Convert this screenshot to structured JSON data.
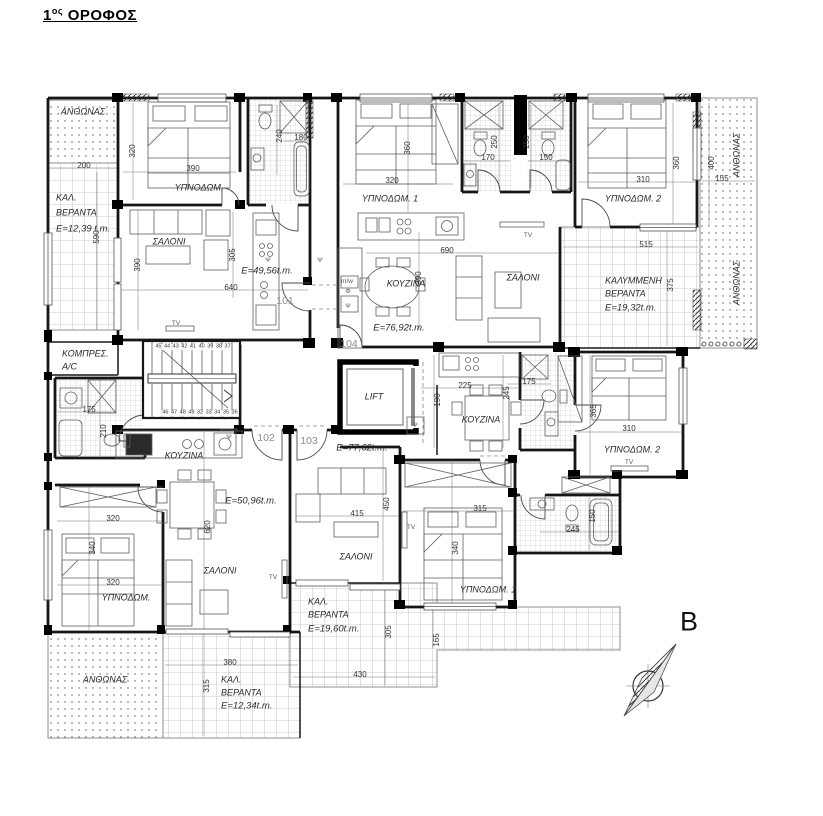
{
  "title": {
    "number": "1",
    "sup": "ος",
    "rest": " ΟΡΟΦΟΣ"
  },
  "plan": {
    "apartments": [
      {
        "number": "101",
        "area": "E=49,56t.m."
      },
      {
        "number": "102",
        "area": "E=50,96t.m."
      },
      {
        "number": "103",
        "area": "E=77,62t.m."
      },
      {
        "number": "104",
        "area": "E=76,92t.m."
      }
    ],
    "labels": [
      {
        "t": "ΑΝΘΩΝΑΣ",
        "x": 83,
        "y": 112,
        "c": "room",
        "n": "planter-label"
      },
      {
        "t": "200",
        "x": 84,
        "y": 166,
        "c": "dim",
        "n": "dim-label"
      },
      {
        "t": "ΚΑΛ.",
        "x": 56,
        "y": 198,
        "c": "room left",
        "n": "veranda-label"
      },
      {
        "t": "ΒΕΡΑΝΤΑ",
        "x": 56,
        "y": 213,
        "c": "room left",
        "n": "veranda-label"
      },
      {
        "t": "E=12,39 t.m.",
        "x": 56,
        "y": 229,
        "c": "area left",
        "n": "area-label"
      },
      {
        "t": "590",
        "x": 97,
        "y": 237,
        "r": -90,
        "c": "dim",
        "n": "dim-label"
      },
      {
        "t": "320",
        "x": 133,
        "y": 151,
        "r": -90,
        "c": "dim",
        "n": "dim-label"
      },
      {
        "t": "390",
        "x": 193,
        "y": 169,
        "c": "dim",
        "n": "dim-label"
      },
      {
        "t": "ΥΠΝΟΔΩΜ.",
        "x": 199,
        "y": 188,
        "c": "room",
        "n": "room-label"
      },
      {
        "t": "240",
        "x": 280,
        "y": 136,
        "r": -90,
        "c": "dim",
        "n": "dim-label"
      },
      {
        "t": "180",
        "x": 301,
        "y": 138,
        "c": "dim",
        "n": "dim-label"
      },
      {
        "t": "ΣΑΛΟΝΙ",
        "x": 169,
        "y": 242,
        "c": "room",
        "n": "room-label"
      },
      {
        "t": "390",
        "x": 138,
        "y": 265,
        "r": -90,
        "c": "dim",
        "n": "dim-label"
      },
      {
        "t": "305",
        "x": 233,
        "y": 255,
        "r": -90,
        "c": "dim",
        "n": "dim-label"
      },
      {
        "t": "E=49,56t.m.",
        "x": 267,
        "y": 271,
        "c": "area",
        "n": "area-label"
      },
      {
        "t": "640",
        "x": 231,
        "y": 288,
        "c": "dim",
        "n": "dim-label"
      },
      {
        "t": "101",
        "x": 285,
        "y": 301,
        "c": "num",
        "n": "apartment-number"
      },
      {
        "t": "TV",
        "x": 176,
        "y": 324,
        "c": "tiny",
        "n": "tv-label"
      },
      {
        "t": "Ψ",
        "x": 268,
        "y": 261,
        "c": "tiny",
        "n": "appliance-label"
      },
      {
        "t": "360",
        "x": 408,
        "y": 148,
        "r": -90,
        "c": "dim",
        "n": "dim-label"
      },
      {
        "t": "320",
        "x": 392,
        "y": 181,
        "c": "dim",
        "n": "dim-label"
      },
      {
        "t": "ΥΠΝΟΔΩΜ. 1",
        "x": 390,
        "y": 199,
        "c": "room",
        "n": "room-label"
      },
      {
        "t": "250",
        "x": 495,
        "y": 142,
        "r": -90,
        "c": "dim",
        "n": "dim-label"
      },
      {
        "t": "170",
        "x": 488,
        "y": 158,
        "c": "dim",
        "n": "dim-label"
      },
      {
        "t": "250",
        "x": 527,
        "y": 142,
        "r": -90,
        "c": "dim",
        "n": "dim-label"
      },
      {
        "t": "150",
        "x": 546,
        "y": 158,
        "c": "dim",
        "n": "dim-label"
      },
      {
        "t": "Ψ",
        "x": 320,
        "y": 261,
        "c": "tiny",
        "n": "appliance-label"
      },
      {
        "t": "m/w",
        "x": 347,
        "y": 282,
        "c": "tiny",
        "n": "appliance-label"
      },
      {
        "t": "Φ",
        "x": 348,
        "y": 292,
        "c": "tiny",
        "n": "appliance-label"
      },
      {
        "t": "Ψ",
        "x": 348,
        "y": 307,
        "c": "tiny",
        "n": "appliance-label"
      },
      {
        "t": "ΚΟΥΖΙΝΑ",
        "x": 406,
        "y": 284,
        "c": "room",
        "n": "room-label"
      },
      {
        "t": "690",
        "x": 447,
        "y": 251,
        "c": "dim",
        "n": "dim-label"
      },
      {
        "t": "390",
        "x": 419,
        "y": 278,
        "r": -90,
        "c": "dim",
        "n": "dim-label"
      },
      {
        "t": "E=76,92t.m.",
        "x": 399,
        "y": 328,
        "c": "area",
        "n": "area-label"
      },
      {
        "t": "ΣΑΛΟΝΙ",
        "x": 523,
        "y": 278,
        "c": "room",
        "n": "room-label"
      },
      {
        "t": "TV",
        "x": 528,
        "y": 236,
        "c": "tiny",
        "n": "tv-label"
      },
      {
        "t": "104",
        "x": 349,
        "y": 344,
        "c": "num",
        "n": "apartment-number"
      },
      {
        "t": "360",
        "x": 677,
        "y": 163,
        "r": -90,
        "c": "dim",
        "n": "dim-label"
      },
      {
        "t": "310",
        "x": 643,
        "y": 180,
        "c": "dim",
        "n": "dim-label"
      },
      {
        "t": "ΥΠΝΟΔΩΜ. 2",
        "x": 633,
        "y": 199,
        "c": "room",
        "n": "room-label"
      },
      {
        "t": "400",
        "x": 712,
        "y": 163,
        "r": -90,
        "c": "dim",
        "n": "dim-label"
      },
      {
        "t": "155",
        "x": 722,
        "y": 179,
        "c": "dim",
        "n": "dim-label"
      },
      {
        "t": "ΑΝΘΩΝΑΣ",
        "x": 737,
        "y": 155,
        "r": -90,
        "c": "room",
        "n": "planter-label"
      },
      {
        "t": "515",
        "x": 646,
        "y": 245,
        "c": "dim",
        "n": "dim-label"
      },
      {
        "t": "ΚΑΛΥΜΜΕΝΗ",
        "x": 605,
        "y": 281,
        "c": "room left",
        "n": "veranda-label"
      },
      {
        "t": "ΒΕΡΑΝΤΑ",
        "x": 605,
        "y": 294,
        "c": "room left",
        "n": "veranda-label"
      },
      {
        "t": "E=19,32t.m.",
        "x": 605,
        "y": 308,
        "c": "area left",
        "n": "area-label"
      },
      {
        "t": "375",
        "x": 671,
        "y": 285,
        "r": -90,
        "c": "dim",
        "n": "dim-label"
      },
      {
        "t": "ΑΝΘΩΝΑΣ",
        "x": 737,
        "y": 283,
        "r": -90,
        "c": "room",
        "n": "planter-label"
      },
      {
        "t": "ΚΟΜΠΡΕΣ.",
        "x": 62,
        "y": 354,
        "c": "room left",
        "n": "room-label"
      },
      {
        "t": "A/C",
        "x": 62,
        "y": 367,
        "c": "room left",
        "n": "room-label"
      },
      {
        "t": "175",
        "x": 89,
        "y": 410,
        "c": "dim",
        "n": "dim-label"
      },
      {
        "t": "210",
        "x": 104,
        "y": 431,
        "r": -90,
        "c": "dim",
        "n": "dim-label"
      },
      {
        "t": "45 44 43 42 41 40 39 38 37",
        "x": 193,
        "y": 347,
        "c": "stair",
        "n": "stair-step-numbers"
      },
      {
        "t": "46 47 48 49 32 33 34 35 36",
        "x": 200,
        "y": 413,
        "c": "stair",
        "n": "stair-step-numbers"
      },
      {
        "t": "LIFT",
        "x": 374,
        "y": 397,
        "c": "room",
        "n": "lift-label"
      },
      {
        "t": "102",
        "x": 266,
        "y": 438,
        "c": "num",
        "n": "apartment-number"
      },
      {
        "t": "103",
        "x": 309,
        "y": 441,
        "c": "num",
        "n": "apartment-number"
      },
      {
        "t": "E=77,62t.m.",
        "x": 362,
        "y": 448,
        "c": "area",
        "n": "area-label"
      },
      {
        "t": "225",
        "x": 465,
        "y": 386,
        "c": "dim",
        "n": "dim-label"
      },
      {
        "t": "190",
        "x": 438,
        "y": 400,
        "r": -90,
        "c": "dim",
        "n": "dim-label"
      },
      {
        "t": "175",
        "x": 529,
        "y": 382,
        "c": "dim",
        "n": "dim-label"
      },
      {
        "t": "245",
        "x": 507,
        "y": 393,
        "r": -90,
        "c": "dim",
        "n": "dim-label"
      },
      {
        "t": "ΚΟΥΖΙΝΑ",
        "x": 481,
        "y": 420,
        "c": "room",
        "n": "room-label"
      },
      {
        "t": "Ψ",
        "x": 415,
        "y": 426,
        "c": "tiny",
        "n": "appliance-label"
      },
      {
        "t": "365",
        "x": 594,
        "y": 411,
        "r": -90,
        "c": "dim",
        "n": "dim-label"
      },
      {
        "t": "310",
        "x": 629,
        "y": 429,
        "c": "dim",
        "n": "dim-label"
      },
      {
        "t": "ΥΠΝΟΔΩΜ. 2",
        "x": 632,
        "y": 450,
        "c": "room",
        "n": "room-label"
      },
      {
        "t": "TV",
        "x": 629,
        "y": 463,
        "c": "tiny",
        "n": "tv-label"
      },
      {
        "t": "245",
        "x": 573,
        "y": 530,
        "c": "dim",
        "n": "dim-label"
      },
      {
        "t": "150",
        "x": 593,
        "y": 516,
        "r": -90,
        "c": "dim",
        "n": "dim-label"
      },
      {
        "t": "ΚΟΥΖΙΝΑ",
        "x": 184,
        "y": 456,
        "c": "room",
        "n": "room-label"
      },
      {
        "t": "Ψ",
        "x": 229,
        "y": 438,
        "c": "tiny",
        "n": "appliance-label"
      },
      {
        "t": "E=50,96t.m.",
        "x": 251,
        "y": 501,
        "c": "area",
        "n": "area-label"
      },
      {
        "t": "320",
        "x": 113,
        "y": 519,
        "c": "dim",
        "n": "dim-label"
      },
      {
        "t": "620",
        "x": 208,
        "y": 527,
        "r": -90,
        "c": "dim",
        "n": "dim-label"
      },
      {
        "t": "340",
        "x": 93,
        "y": 548,
        "r": -90,
        "c": "dim",
        "n": "dim-label"
      },
      {
        "t": "ΣΑΛΟΝΙ",
        "x": 220,
        "y": 571,
        "c": "room",
        "n": "room-label"
      },
      {
        "t": "TV",
        "x": 273,
        "y": 578,
        "c": "tiny",
        "n": "tv-label"
      },
      {
        "t": "320",
        "x": 113,
        "y": 583,
        "c": "dim",
        "n": "dim-label"
      },
      {
        "t": "ΥΠΝΟΔΩΜ.",
        "x": 126,
        "y": 598,
        "c": "room",
        "n": "room-label"
      },
      {
        "t": "415",
        "x": 357,
        "y": 514,
        "c": "dim",
        "n": "dim-label"
      },
      {
        "t": "450",
        "x": 387,
        "y": 504,
        "r": -90,
        "c": "dim",
        "n": "dim-label"
      },
      {
        "t": "315",
        "x": 480,
        "y": 509,
        "c": "dim",
        "n": "dim-label"
      },
      {
        "t": "TV",
        "x": 411,
        "y": 528,
        "c": "tiny",
        "n": "tv-label"
      },
      {
        "t": "340",
        "x": 456,
        "y": 548,
        "r": -90,
        "c": "dim",
        "n": "dim-label"
      },
      {
        "t": "ΣΑΛΟΝΙ",
        "x": 356,
        "y": 557,
        "c": "room",
        "n": "room-label"
      },
      {
        "t": "ΥΠΝΟΔΩΜ. 1",
        "x": 488,
        "y": 590,
        "c": "room",
        "n": "room-label"
      },
      {
        "t": "ΚΑΛ.",
        "x": 308,
        "y": 602,
        "c": "room left",
        "n": "veranda-label"
      },
      {
        "t": "ΒΕΡΑΝΤΑ",
        "x": 308,
        "y": 615,
        "c": "room left",
        "n": "veranda-label"
      },
      {
        "t": "E=19,60t.m.",
        "x": 308,
        "y": 629,
        "c": "area left",
        "n": "area-label"
      },
      {
        "t": "305",
        "x": 389,
        "y": 632,
        "r": -90,
        "c": "dim",
        "n": "dim-label"
      },
      {
        "t": "165",
        "x": 437,
        "y": 640,
        "r": -90,
        "c": "dim",
        "n": "dim-label"
      },
      {
        "t": "430",
        "x": 360,
        "y": 675,
        "c": "dim",
        "n": "dim-label"
      },
      {
        "t": "ΑΝΘΩΝΑΣ",
        "x": 105,
        "y": 680,
        "c": "room",
        "n": "planter-label"
      },
      {
        "t": "380",
        "x": 230,
        "y": 663,
        "c": "dim",
        "n": "dim-label"
      },
      {
        "t": "315",
        "x": 207,
        "y": 686,
        "r": -90,
        "c": "dim",
        "n": "dim-label"
      },
      {
        "t": "ΚΑΛ.",
        "x": 221,
        "y": 680,
        "c": "room left",
        "n": "veranda-label"
      },
      {
        "t": "ΒΕΡΑΝΤΑ",
        "x": 221,
        "y": 693,
        "c": "room left",
        "n": "veranda-label"
      },
      {
        "t": "E=12,34t.m.",
        "x": 221,
        "y": 706,
        "c": "area left",
        "n": "area-label"
      },
      {
        "t": "B",
        "x": 689,
        "y": 622,
        "c": "compass",
        "n": "north-label"
      }
    ]
  }
}
